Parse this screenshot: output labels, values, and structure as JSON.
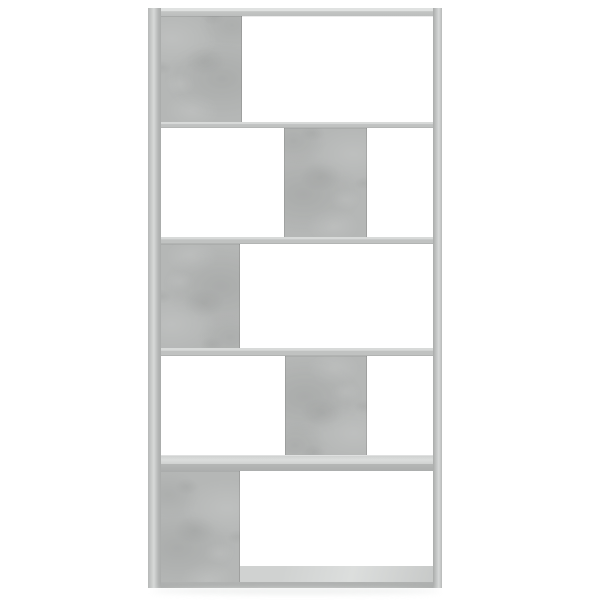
{
  "meta": {
    "type": "product-photo",
    "alt_text": "Front view of a tall five-tier book cabinet room divider in concrete grey on a plain white background; each tier has one solid concrete-grey panel alternating between the left side and the centre, creating a staggered zigzag pattern of open and closed compartments"
  },
  "product": {
    "name": "Book cabinet / room divider",
    "finish": "Concrete grey",
    "tiers": 5,
    "panel_pattern": [
      "left",
      "center",
      "left",
      "center",
      "left"
    ],
    "open_compartments": true
  },
  "colors": {
    "bg": "#ffffff",
    "panel": "#b5b7b6",
    "panel_dark": "#a9abaa",
    "panel_light": "#c6c8c7",
    "frame": "#c3c5c4",
    "frame_light": "#d7d9d8",
    "top_lip": "#e0e2e1",
    "shelf_top": "#d8dad9",
    "shelf_face": "#c0c2c1",
    "shelf_bottom": "#a6a8a7",
    "floor": "#d0d2d1",
    "floor_light": "#dcdedd",
    "base_front": "#b1b3b2",
    "shadow": "#e9ebea"
  }
}
